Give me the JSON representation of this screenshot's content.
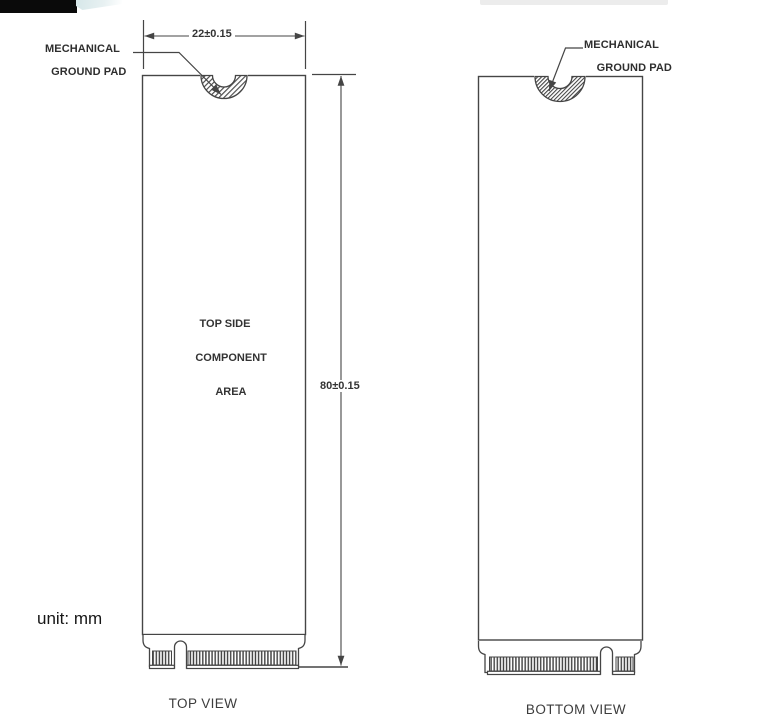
{
  "drawing": {
    "unit_note": "unit: mm",
    "width_dimension": "22±0.15",
    "height_dimension": "80±0.15",
    "ground_pad_label": {
      "line1": "MECHANICAL",
      "line2": "GROUND PAD"
    },
    "component_area_label": {
      "line1": "TOP SIDE",
      "line2": "COMPONENT",
      "line3": "AREA"
    },
    "top_view_caption": "TOP VIEW",
    "bottom_view_caption": "BOTTOM VIEW"
  },
  "colors": {
    "line": "#454545",
    "hatch": "#4a4a4a",
    "text": "#2e2e2e",
    "black_bar": "#0a0a0a"
  }
}
